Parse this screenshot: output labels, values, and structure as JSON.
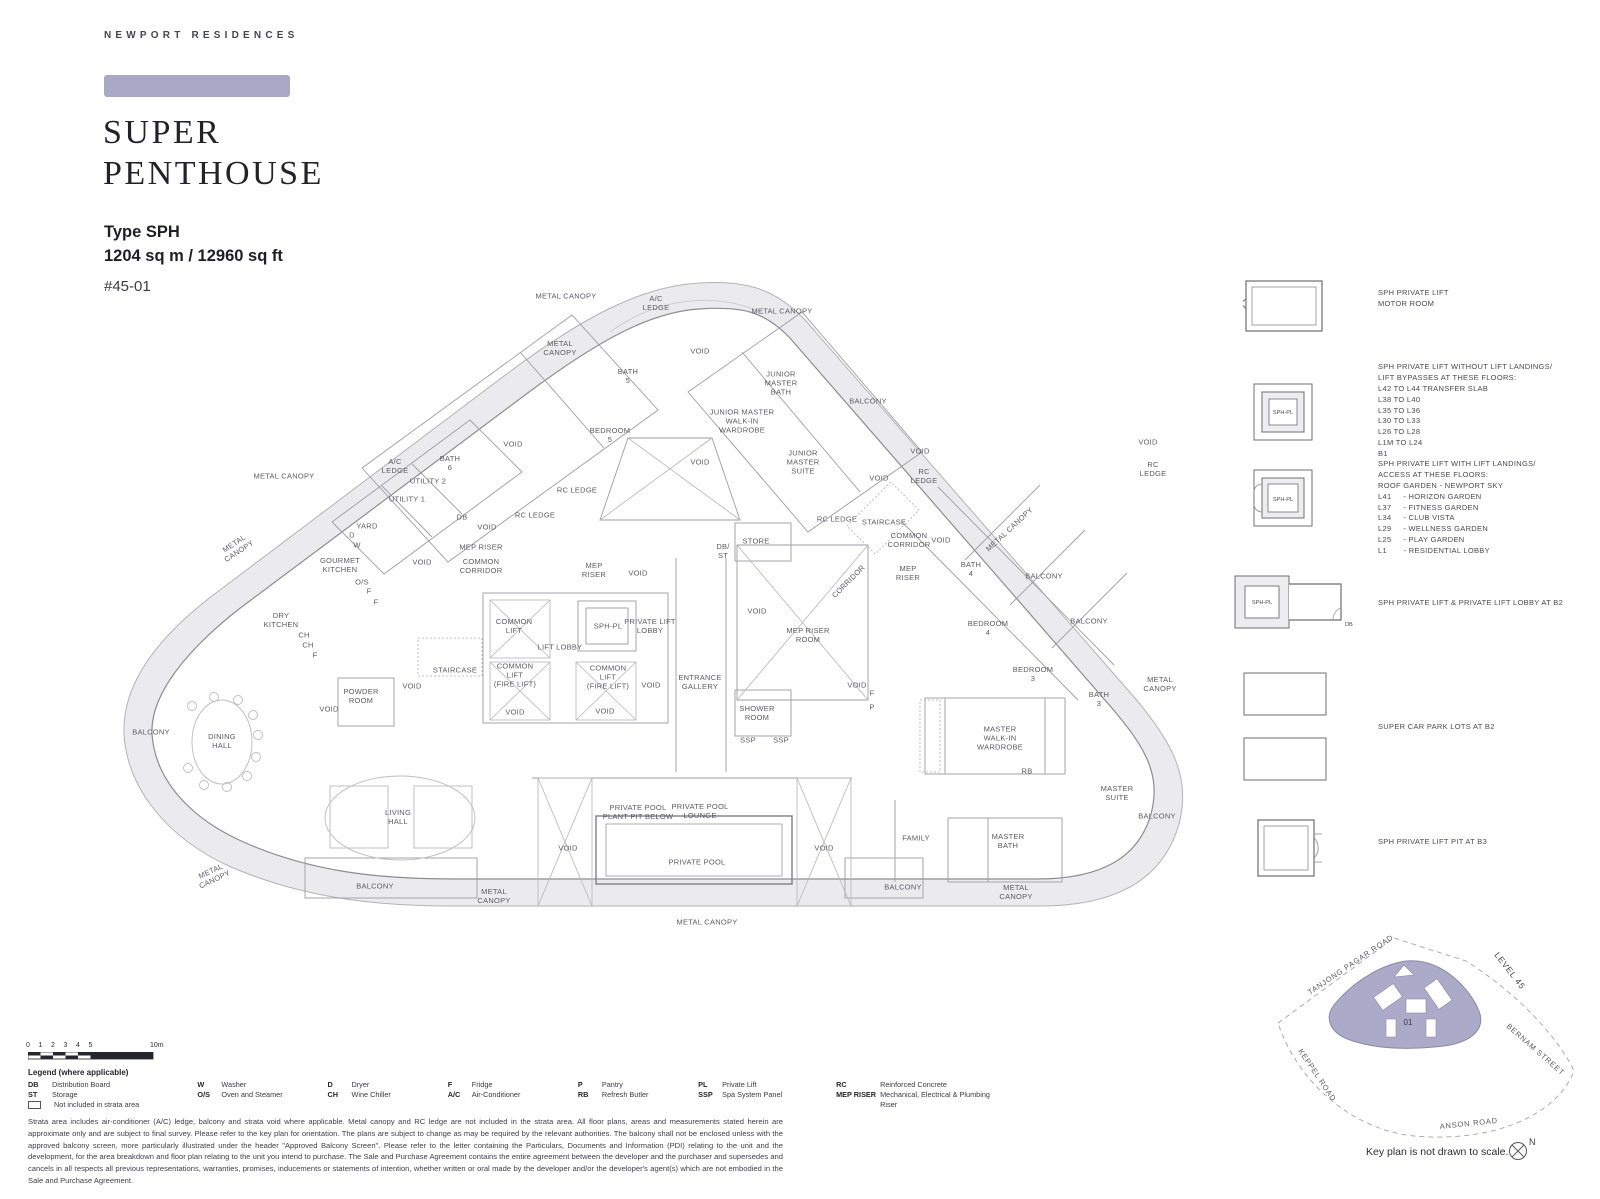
{
  "header": {
    "brand": "NEWPORT RESIDENCES",
    "accent_color": "#a9a9c7",
    "title_line1": "SUPER",
    "title_line2": "PENTHOUSE",
    "type_label": "Type SPH",
    "area_label": "1204 sq m / 12960 sq ft",
    "unit_label": "#45-01"
  },
  "floorplan": {
    "labels": [
      {
        "t": "METAL CANOPY",
        "x": 566,
        "y": 297
      },
      {
        "t": "A/C\nLEDGE",
        "x": 656,
        "y": 304
      },
      {
        "t": "METAL CANOPY",
        "x": 782,
        "y": 312
      },
      {
        "t": "METAL\nCANOPY",
        "x": 560,
        "y": 349
      },
      {
        "t": "VOID",
        "x": 700,
        "y": 352
      },
      {
        "t": "BATH\n5",
        "x": 628,
        "y": 377
      },
      {
        "t": "JUNIOR\nMASTER\nBATH",
        "x": 781,
        "y": 384
      },
      {
        "t": "JUNIOR MASTER\nWALK-IN\nWARDROBE",
        "x": 742,
        "y": 422
      },
      {
        "t": "BALCONY",
        "x": 868,
        "y": 402
      },
      {
        "t": "BEDROOM\n5",
        "x": 610,
        "y": 436
      },
      {
        "t": "VOID",
        "x": 700,
        "y": 463
      },
      {
        "t": "JUNIOR\nMASTER\nSUITE",
        "x": 803,
        "y": 463
      },
      {
        "t": "VOID",
        "x": 920,
        "y": 452
      },
      {
        "t": "RC\nLEDGE",
        "x": 924,
        "y": 477
      },
      {
        "t": "VOID",
        "x": 1148,
        "y": 443
      },
      {
        "t": "RC\nLEDGE",
        "x": 1153,
        "y": 470
      },
      {
        "t": "VOID",
        "x": 879,
        "y": 479
      },
      {
        "t": "RC LEDGE",
        "x": 837,
        "y": 520
      },
      {
        "t": "STAIRCASE",
        "x": 884,
        "y": 523
      },
      {
        "t": "COMMON\nCORRIDOR",
        "x": 909,
        "y": 541
      },
      {
        "t": "VOID",
        "x": 941,
        "y": 541
      },
      {
        "t": "MEP\nRISER",
        "x": 908,
        "y": 574
      },
      {
        "t": "CORRIDOR",
        "x": 849,
        "y": 582,
        "r": -45
      },
      {
        "t": "METAL CANOPY",
        "x": 1010,
        "y": 530,
        "r": -43
      },
      {
        "t": "BATH\n4",
        "x": 971,
        "y": 570
      },
      {
        "t": "BALCONY",
        "x": 1044,
        "y": 577
      },
      {
        "t": "BEDROOM\n4",
        "x": 988,
        "y": 629
      },
      {
        "t": "BALCONY",
        "x": 1089,
        "y": 622
      },
      {
        "t": "BEDROOM\n3",
        "x": 1033,
        "y": 675
      },
      {
        "t": "METAL\nCANOPY",
        "x": 1160,
        "y": 685
      },
      {
        "t": "BATH\n3",
        "x": 1099,
        "y": 700
      },
      {
        "t": "MASTER\nWALK-IN\nWARDROBE",
        "x": 1000,
        "y": 739
      },
      {
        "t": "RB",
        "x": 1027,
        "y": 772
      },
      {
        "t": "MASTER\nSUITE",
        "x": 1117,
        "y": 794
      },
      {
        "t": "BALCONY",
        "x": 1157,
        "y": 817
      },
      {
        "t": "FAMILY",
        "x": 916,
        "y": 839
      },
      {
        "t": "MASTER\nBATH",
        "x": 1008,
        "y": 842
      },
      {
        "t": "BALCONY",
        "x": 903,
        "y": 888
      },
      {
        "t": "METAL\nCANOPY",
        "x": 1016,
        "y": 893
      },
      {
        "t": "METAL CANOPY",
        "x": 284,
        "y": 477
      },
      {
        "t": "A/C\nLEDGE",
        "x": 395,
        "y": 467
      },
      {
        "t": "BATH\n6",
        "x": 450,
        "y": 464
      },
      {
        "t": "UTILITY 2",
        "x": 428,
        "y": 482
      },
      {
        "t": "UTILITY 1",
        "x": 407,
        "y": 500
      },
      {
        "t": "YARD",
        "x": 367,
        "y": 527
      },
      {
        "t": "D",
        "x": 352,
        "y": 536
      },
      {
        "t": "W",
        "x": 357,
        "y": 546
      },
      {
        "t": "DB",
        "x": 462,
        "y": 518
      },
      {
        "t": "VOID",
        "x": 487,
        "y": 528
      },
      {
        "t": "RC LEDGE",
        "x": 535,
        "y": 516
      },
      {
        "t": "RC LEDGE",
        "x": 577,
        "y": 491
      },
      {
        "t": "VOID",
        "x": 513,
        "y": 445
      },
      {
        "t": "MEP RISER",
        "x": 481,
        "y": 548
      },
      {
        "t": "COMMON\nCORRIDOR",
        "x": 481,
        "y": 567
      },
      {
        "t": "METAL\nCANOPY",
        "x": 237,
        "y": 548,
        "r": -33
      },
      {
        "t": "GOURMET\nKITCHEN",
        "x": 340,
        "y": 566
      },
      {
        "t": "O/S",
        "x": 362,
        "y": 583
      },
      {
        "t": "F",
        "x": 369,
        "y": 592
      },
      {
        "t": "F",
        "x": 376,
        "y": 603
      },
      {
        "t": "DRY\nKITCHEN",
        "x": 281,
        "y": 621
      },
      {
        "t": "CH",
        "x": 304,
        "y": 636
      },
      {
        "t": "CH",
        "x": 308,
        "y": 646
      },
      {
        "t": "F",
        "x": 315,
        "y": 656
      },
      {
        "t": "VOID",
        "x": 422,
        "y": 563
      },
      {
        "t": "MEP\nRISER",
        "x": 594,
        "y": 571
      },
      {
        "t": "VOID",
        "x": 638,
        "y": 574
      },
      {
        "t": "COMMON\nLIFT",
        "x": 514,
        "y": 627
      },
      {
        "t": "LIFT LOBBY",
        "x": 560,
        "y": 648
      },
      {
        "t": "SPH-PL",
        "x": 608,
        "y": 627
      },
      {
        "t": "PRIVATE LIFT\nLOBBY",
        "x": 650,
        "y": 627
      },
      {
        "t": "COMMON\nLIFT\n(FIRE LIFT)",
        "x": 515,
        "y": 676
      },
      {
        "t": "COMMON\nLIFT\n(FIRE LIFT)",
        "x": 608,
        "y": 678
      },
      {
        "t": "VOID",
        "x": 651,
        "y": 686
      },
      {
        "t": "STAIRCASE",
        "x": 455,
        "y": 671
      },
      {
        "t": "VOID",
        "x": 515,
        "y": 713
      },
      {
        "t": "VOID",
        "x": 605,
        "y": 712
      },
      {
        "t": "ENTRANCE\nGALLERY",
        "x": 700,
        "y": 683
      },
      {
        "t": "STORE",
        "x": 756,
        "y": 542
      },
      {
        "t": "DB/\nST",
        "x": 723,
        "y": 552
      },
      {
        "t": "VOID",
        "x": 757,
        "y": 612
      },
      {
        "t": "MEP RISER\nROOM",
        "x": 808,
        "y": 636
      },
      {
        "t": "F",
        "x": 872,
        "y": 694
      },
      {
        "t": "P",
        "x": 872,
        "y": 708
      },
      {
        "t": "SHOWER\nROOM",
        "x": 757,
        "y": 714
      },
      {
        "t": "SSP",
        "x": 748,
        "y": 741
      },
      {
        "t": "SSP",
        "x": 781,
        "y": 741
      },
      {
        "t": "VOID",
        "x": 857,
        "y": 686
      },
      {
        "t": "VOID",
        "x": 329,
        "y": 710
      },
      {
        "t": "POWDER\nROOM",
        "x": 361,
        "y": 697
      },
      {
        "t": "VOID",
        "x": 412,
        "y": 687
      },
      {
        "t": "BALCONY",
        "x": 151,
        "y": 733
      },
      {
        "t": "DINING\nHALL",
        "x": 222,
        "y": 742
      },
      {
        "t": "LIVING\nHALL",
        "x": 398,
        "y": 818
      },
      {
        "t": "VOID",
        "x": 568,
        "y": 849
      },
      {
        "t": "PRIVATE POOL\nPLANT PIT BELOW",
        "x": 638,
        "y": 813
      },
      {
        "t": "PRIVATE POOL\nLOUNGE",
        "x": 700,
        "y": 812
      },
      {
        "t": "PRIVATE POOL",
        "x": 697,
        "y": 863
      },
      {
        "t": "VOID",
        "x": 824,
        "y": 849
      },
      {
        "t": "BALCONY",
        "x": 375,
        "y": 887
      },
      {
        "t": "METAL\nCANOPY",
        "x": 494,
        "y": 897
      },
      {
        "t": "METAL CANOPY",
        "x": 707,
        "y": 923
      },
      {
        "t": "METAL\nCANOPY",
        "x": 213,
        "y": 876,
        "r": -25
      }
    ]
  },
  "right_legend": {
    "sph_pl_label": "SPH-PL",
    "db_label": "DB",
    "items": [
      {
        "lines": [
          "SPH PRIVATE LIFT",
          "MOTOR ROOM"
        ]
      },
      {
        "lines": [
          "SPH PRIVATE LIFT WITHOUT LIFT LANDINGS/",
          "LIFT BYPASSES AT THESE FLOORS:",
          "L42 TO L44 TRANSFER SLAB",
          "L38 TO L40",
          "L35 TO L36",
          "L30 TO L33",
          "L26 TO L28",
          "L1M TO L24",
          "B1"
        ]
      },
      {
        "lines": [
          "SPH PRIVATE LIFT WITH LIFT LANDINGS/",
          "ACCESS AT THESE FLOORS:",
          "ROOF GARDEN - NEWPORT SKY",
          "L41     - HORIZON GARDEN",
          "L37     - FITNESS GARDEN",
          "L34     - CLUB VISTA",
          "L29     - WELLNESS GARDEN",
          "L25     - PLAY GARDEN",
          "L1       - RESIDENTIAL LOBBY"
        ]
      },
      {
        "lines": [
          "SPH PRIVATE LIFT & PRIVATE LIFT LOBBY AT B2"
        ]
      },
      {
        "lines": [
          "SUPER CAR PARK LOTS AT B2"
        ]
      },
      {
        "lines": [
          "SPH PRIVATE LIFT PIT AT B3"
        ]
      }
    ]
  },
  "scale_bar": {
    "ticks": [
      "0",
      "1",
      "2",
      "3",
      "4",
      "5"
    ],
    "end_label": "10m"
  },
  "legend": {
    "title": "Legend (where applicable)",
    "columns": [
      [
        [
          "DB",
          "Distribution Board"
        ],
        [
          "ST",
          "Storage"
        ],
        [
          "[]",
          "Not included in strata area"
        ]
      ],
      [
        [
          "W",
          "Washer"
        ],
        [
          "O/S",
          "Oven and Steamer"
        ]
      ],
      [
        [
          "D",
          "Dryer"
        ],
        [
          "CH",
          "Wine Chiller"
        ]
      ],
      [
        [
          "F",
          "Fridge"
        ],
        [
          "A/C",
          "Air-Conditioner"
        ]
      ],
      [
        [
          "P",
          "Pantry"
        ],
        [
          "RB",
          "Refresh Butler"
        ]
      ],
      [
        [
          "PL",
          "Private Lift"
        ],
        [
          "SSP",
          "Spa System Panel"
        ]
      ],
      [
        [
          "RC",
          "Reinforced Concrete"
        ],
        [
          "MEP RISER",
          "Mechanical, Electrical & Plumbing Riser"
        ]
      ]
    ]
  },
  "disclaimer": "Strata area includes air-conditioner (A/C) ledge, balcony and strata void where applicable. Metal canopy and RC ledge are not included in the strata area. All floor plans, areas and measurements stated herein are approximate only and are subject to final survey. Please refer to the key plan for orientation. The plans are subject to change as may be required by the relevant authorities. The balcony shall not be enclosed unless with the approved balcony screen, more particularly illustrated under the header \"Approved Balcony Screen\". Please refer to the letter containing the Particulars, Documents and Information (PDI) relating to the unit and the development, for the area breakdown and floor plan relating to the unit you intend to purchase.  The Sale and Purchase Agreement contains the entire agreement between the developer and the purchaser and supersedes and cancels in all respects all previous representations, warranties, promises, inducements or statements of intention, whether written or oral made by the developer and/or the developer's agent(s) which are not embodied in the Sale and Purchase Agreement.",
  "keyplan": {
    "roads": [
      "TANJONG PAGAR ROAD",
      "BERNAM STREET",
      "KEPPEL ROAD",
      "ANSON ROAD"
    ],
    "level_label": "LEVEL 45",
    "unit_number": "01",
    "building_color": "#abaac9",
    "caption": "Key plan is not drawn to scale.",
    "north_label": "N"
  }
}
